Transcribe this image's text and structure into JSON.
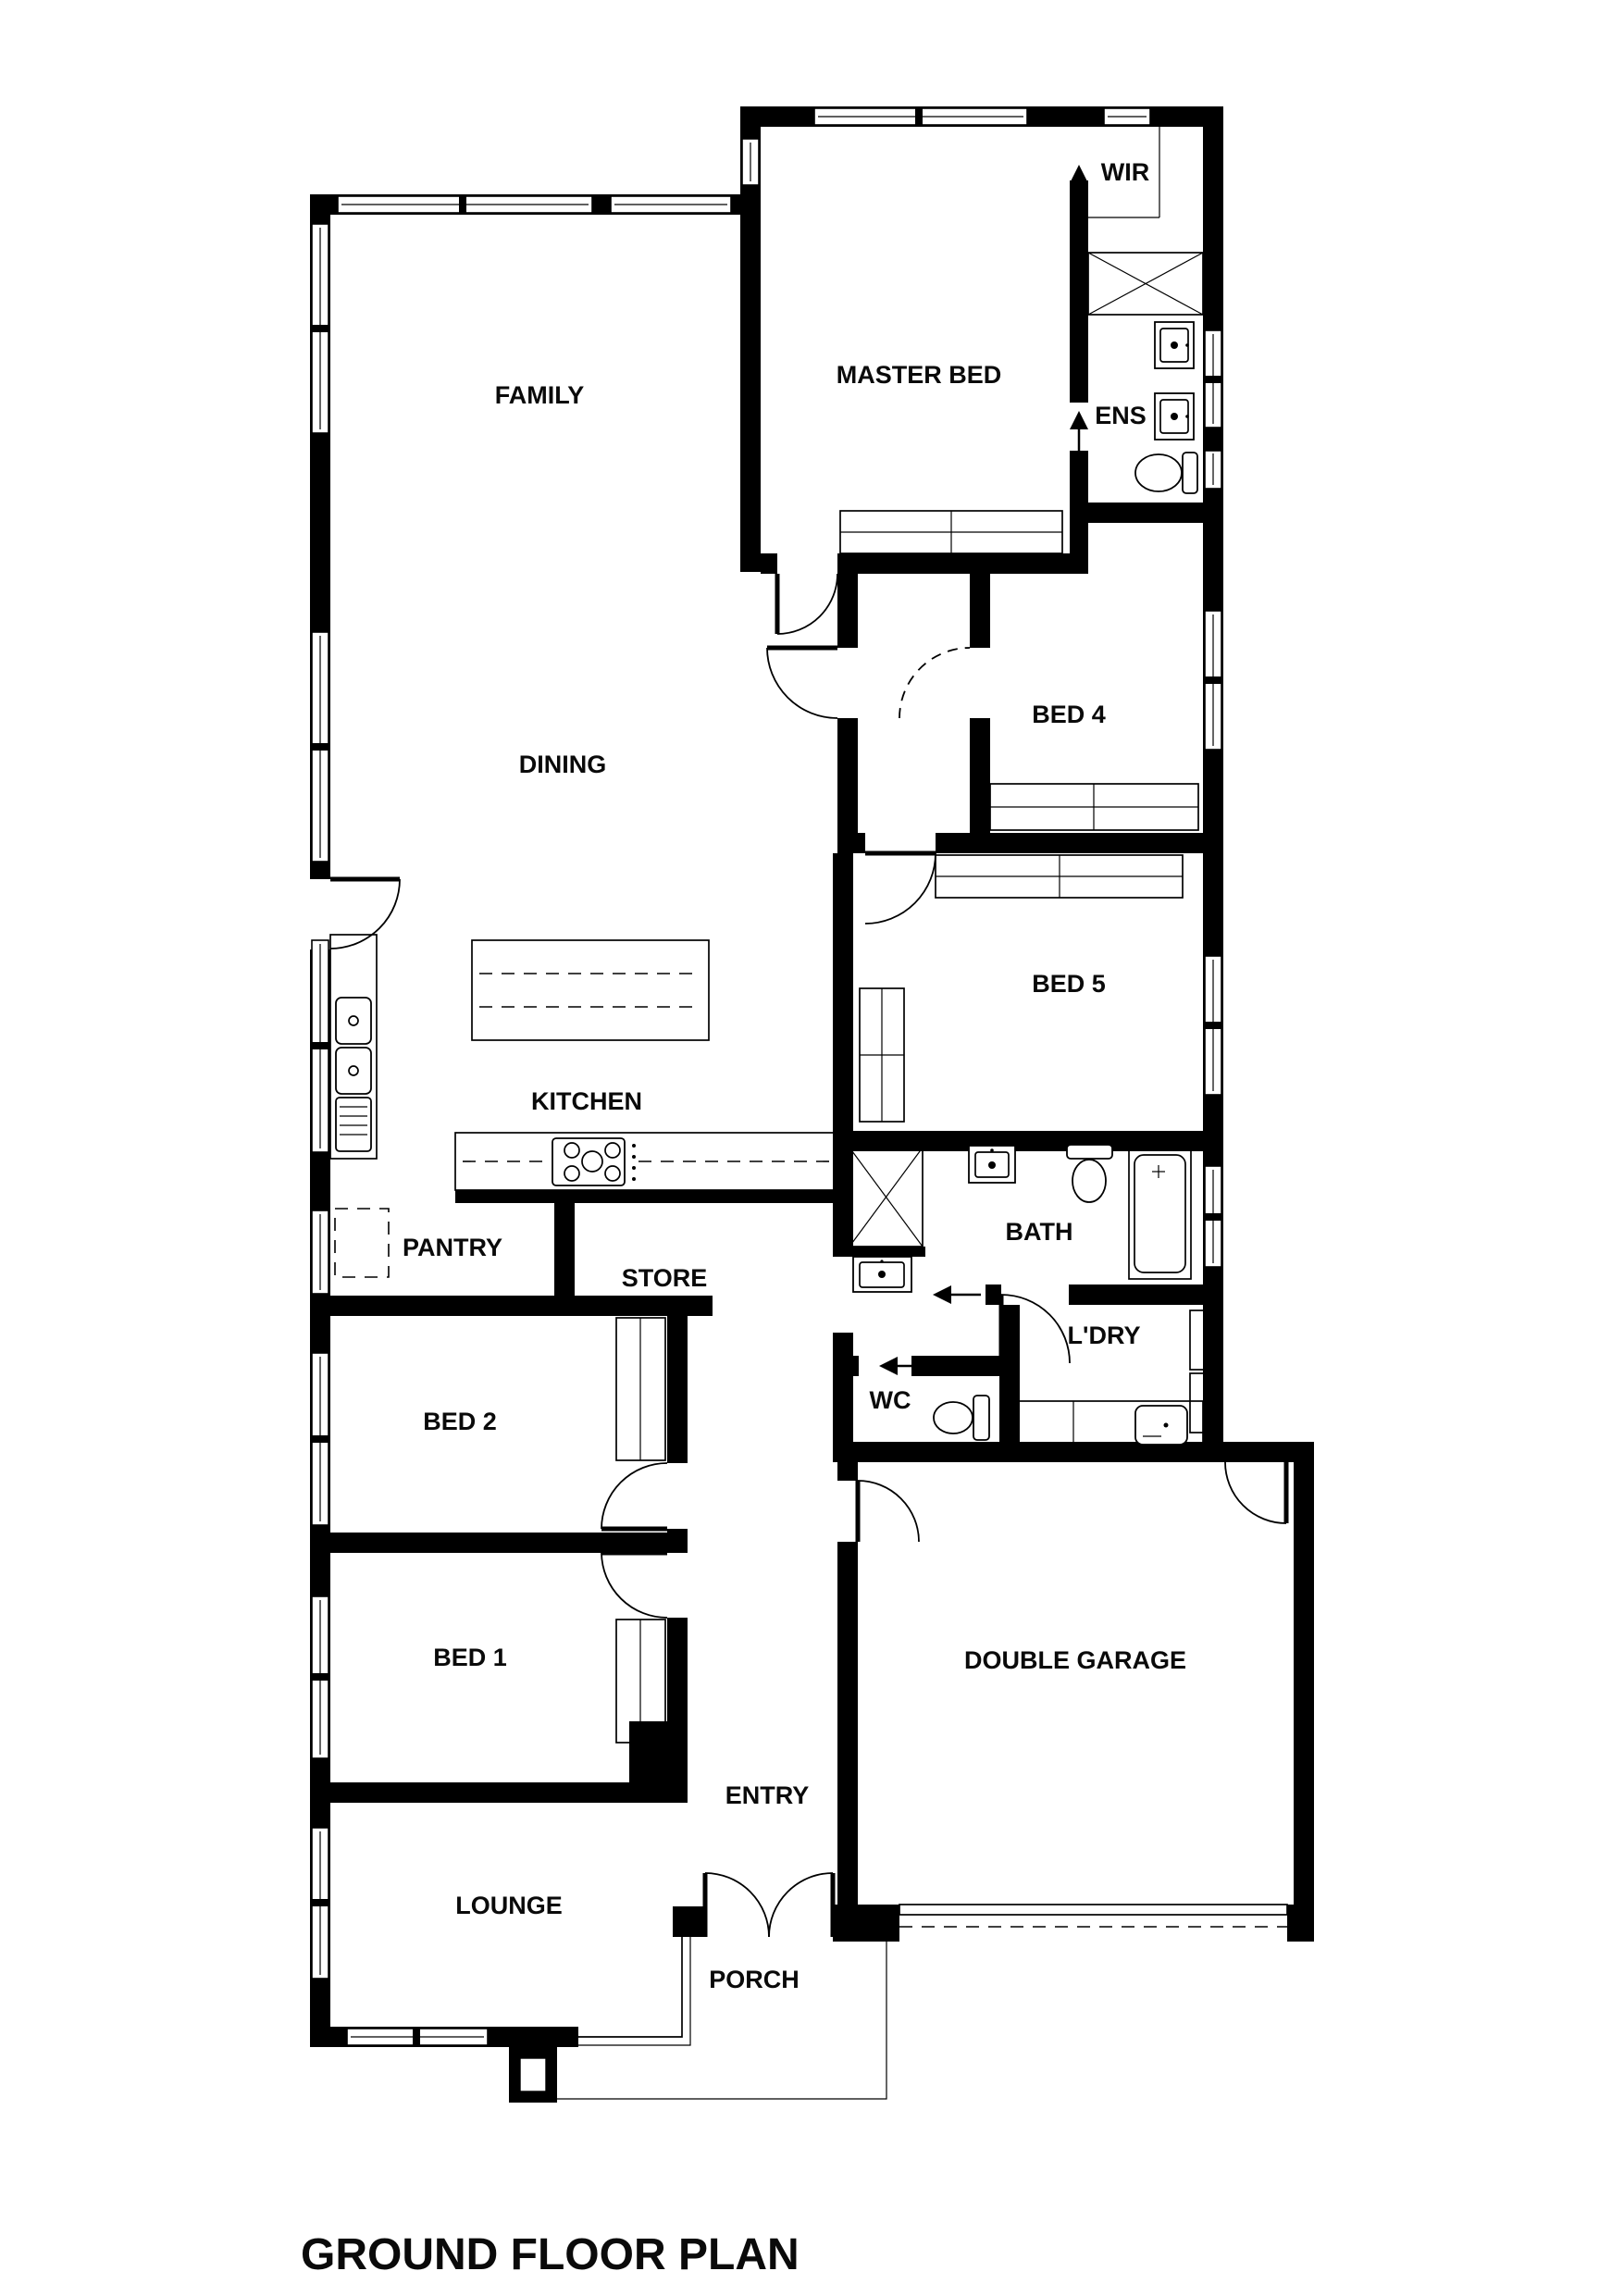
{
  "header": {
    "title": "GROUND FLOOR PLAN"
  },
  "rooms": {
    "family": {
      "label": "FAMILY"
    },
    "dining": {
      "label": "DINING"
    },
    "kitchen": {
      "label": "KITCHEN"
    },
    "pantry": {
      "label": "PANTRY"
    },
    "store": {
      "label": "STORE"
    },
    "master_bed": {
      "label": "MASTER BED"
    },
    "wir": {
      "label": "WIR"
    },
    "ens": {
      "label": "ENS"
    },
    "bed4": {
      "label": "BED 4"
    },
    "bed5": {
      "label": "BED 5"
    },
    "bath": {
      "label": "BATH"
    },
    "laundry": {
      "label": "L'DRY"
    },
    "wc": {
      "label": "WC"
    },
    "bed2": {
      "label": "BED 2"
    },
    "bed1": {
      "label": "BED 1"
    },
    "garage": {
      "label": "DOUBLE GARAGE"
    },
    "entry": {
      "label": "ENTRY"
    },
    "lounge": {
      "label": "LOUNGE"
    },
    "porch": {
      "label": "PORCH"
    }
  },
  "icons": {
    "wir_entry": "up-arrow",
    "ens_entry": "up-arrow",
    "bath_slider": "left-arrow",
    "wc_slider": "left-arrow"
  },
  "colors": {
    "wall": "#000000",
    "background": "#ffffff",
    "fixture_line": "#000000",
    "label": "#0a0a0a"
  }
}
